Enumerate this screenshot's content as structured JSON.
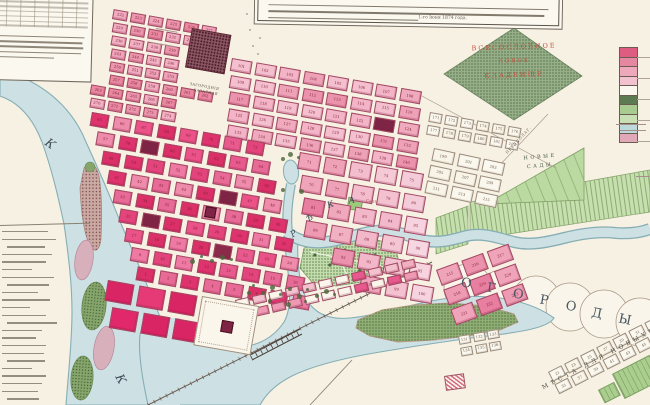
{
  "map_type": "historical-city-plan",
  "colors": {
    "paper": "#f6f1e3",
    "water": "#cde1e4",
    "water_edge": "#86aeb4",
    "block_stroke": "#a04a62",
    "number_ink": "#7d1f35",
    "maroon_block": "#7e2445"
  },
  "annotations": {
    "note_fragment": "1-го Іюня 1874 года.",
    "note_lines_illegible": 3,
    "table_columns": 6,
    "table_rows": 9,
    "table_paragraph_lines": 5,
    "index_list_lines": 23
  },
  "labels": [
    {
      "t": "ВСЕСОСЛОВНОЕ",
      "x": 452,
      "y": 46,
      "r": -2,
      "s": 6.5,
      "ls": 2,
      "c": "#c05040",
      "w": 124,
      "ctr": true
    },
    {
      "t": "НОВОЕ",
      "x": 452,
      "y": 60,
      "r": -2,
      "s": 5.5,
      "ls": 2,
      "c": "#c05040",
      "w": 124,
      "ctr": true
    },
    {
      "t": "КЛАДБИЩЕ",
      "x": 452,
      "y": 74,
      "r": -2,
      "s": 6.5,
      "ls": 2,
      "c": "#c05040",
      "w": 124,
      "ctr": true
    },
    {
      "t": "НОВЫЕ",
      "x": 512,
      "y": 157,
      "r": -5,
      "s": 5,
      "ls": 2.5,
      "c": "#44583e",
      "w": 56,
      "ctr": true
    },
    {
      "t": "САДЫ",
      "x": 512,
      "y": 166,
      "r": -5,
      "s": 5,
      "ls": 2.5,
      "c": "#44583e",
      "w": 56,
      "ctr": true
    },
    {
      "t": "О",
      "x": 462,
      "y": 276,
      "r": 8,
      "s": 13,
      "c": "#4a5660"
    },
    {
      "t": "Г",
      "x": 488,
      "y": 281,
      "r": 8,
      "s": 13,
      "c": "#4a5660"
    },
    {
      "t": "О",
      "x": 514,
      "y": 287,
      "r": 9,
      "s": 13,
      "c": "#4a5660"
    },
    {
      "t": "Р",
      "x": 541,
      "y": 293,
      "r": 10,
      "s": 13,
      "c": "#4a5660"
    },
    {
      "t": "О",
      "x": 567,
      "y": 299,
      "r": 10,
      "s": 13,
      "c": "#4a5660"
    },
    {
      "t": "Д",
      "x": 593,
      "y": 306,
      "r": 11,
      "s": 13,
      "c": "#4a5660"
    },
    {
      "t": "Ы",
      "x": 620,
      "y": 312,
      "r": 12,
      "s": 13,
      "c": "#4a5660"
    },
    {
      "t": "Р",
      "x": 289,
      "y": 232,
      "r": -32,
      "s": 8.5,
      "c": "#3f4c55",
      "i": true
    },
    {
      "t": "Ѣ",
      "x": 305,
      "y": 216,
      "r": -28,
      "s": 8.5,
      "c": "#3f4c55",
      "i": true
    },
    {
      "t": "К",
      "x": 326,
      "y": 202,
      "r": -20,
      "s": 8.5,
      "c": "#3f4c55",
      "i": true
    },
    {
      "t": "А",
      "x": 348,
      "y": 197,
      "r": -8,
      "s": 8.5,
      "c": "#3f4c55",
      "i": true
    },
    {
      "t": "К",
      "x": 50,
      "y": 136,
      "r": 36,
      "s": 12,
      "c": "#3f4c55",
      "i": true
    },
    {
      "t": "К",
      "x": 124,
      "y": 372,
      "r": 62,
      "s": 12,
      "c": "#3f4c55",
      "i": true
    },
    {
      "t": "МѢСТА ДЛЯ НОВЫХЪ САДОВЪ",
      "x": 541,
      "y": 385,
      "r": -27.5,
      "s": 6,
      "ls": 3.5,
      "c": "#4f4e44"
    },
    {
      "t": "ПРЕДПОЛАГ.",
      "x": 505,
      "y": 152,
      "r": -47,
      "s": 3.8,
      "ls": 0.8,
      "c": "#6b5f52"
    },
    {
      "t": "ЗАГОРОДНІЯ",
      "x": 190,
      "y": 82,
      "r": 10,
      "s": 3.6,
      "ls": 0.4,
      "c": "#5c4a42"
    },
    {
      "t": "БАЗАРНАЯ",
      "x": 194,
      "y": 88,
      "r": 10,
      "s": 3.6,
      "ls": 0.4,
      "c": "#5c4a42"
    },
    {
      "t": "Садъ",
      "x": 366,
      "y": 199,
      "r": 4,
      "s": 4,
      "ls": 0.3,
      "c": "#a84444"
    }
  ],
  "palettes": {
    "light": [
      "#f2b4c6",
      "#eea2b8",
      "#f4bfce",
      "#eb93ad",
      "#f0aabe"
    ],
    "light2": [
      "#efa4ba",
      "#ec96ae",
      "#f2b2c4",
      "#ea88a2",
      "#f0acc0"
    ],
    "medium": [
      "#ec92ac",
      "#e87ea0",
      "#f0a4ba",
      "#ee9ab2"
    ],
    "vivid": [
      "#e85a8e",
      "#e4447c",
      "#ee7aa4",
      "#df336e",
      "#ea5288",
      "#e86a96",
      "#db2f68",
      "#ef8cab"
    ],
    "crimson": [
      "#e1286a",
      "#d92564",
      "#e63a76",
      "#dd2f6c"
    ],
    "white": [
      "#faf7ee",
      "#f8f4e8",
      "#fbf8f0"
    ],
    "mixed": [
      "#faf6ec",
      "#ef9ab4",
      "#e4447c",
      "#f4c2cf",
      "#faf6ec",
      "#e85a8e",
      "#f0b0c0",
      "#faf6ec"
    ]
  },
  "districts": [
    {
      "id": "nw",
      "x": 96,
      "y": 6,
      "rot": 10,
      "rows": 8,
      "cols": 7,
      "cw": 15,
      "ch": 10,
      "gx": 3,
      "gy": 3,
      "shift": 1.5,
      "palette": "light2",
      "numStart": 221,
      "seed": 11,
      "skips": [
        "0,0",
        "1,0",
        "2,0",
        "3,0",
        "4,0",
        "5,0",
        "2,5",
        "2,6",
        "3,5",
        "3,6",
        "4,5",
        "4,6",
        "6,5",
        "6,6",
        "7,5",
        "7,6"
      ]
    },
    {
      "id": "ne",
      "x": 232,
      "y": 58,
      "rot": 10,
      "rows": 5,
      "cols": 8,
      "cw": 21,
      "ch": 13,
      "gx": 3.5,
      "gy": 3.5,
      "shift": 2,
      "palette": "light",
      "numStart": 101,
      "seed": 7,
      "overrides": [
        {
          "r": 2,
          "c": 6,
          "color": "#7e2445"
        }
      ]
    },
    {
      "id": "se-white",
      "x": 430,
      "y": 112,
      "rot": 10,
      "rows": 2,
      "cols": 6,
      "cw": 13,
      "ch": 10,
      "gx": 3,
      "gy": 3,
      "palette": "white",
      "numStart": 171,
      "seed": 3
    },
    {
      "id": "e-parcels",
      "x": 434,
      "y": 148,
      "rot": 12,
      "rows": 3,
      "cols": 3,
      "cw": 22,
      "ch": 13,
      "gx": 3.5,
      "gy": 3.5,
      "palette": "white",
      "numStart": 199,
      "numStep": 2,
      "seed": 4
    },
    {
      "id": "core",
      "x": 92,
      "y": 112,
      "rot": 10,
      "rows": 9,
      "cols": 8,
      "cw": 18,
      "ch": 14,
      "gx": 4.5,
      "gy": 4,
      "shift": 9,
      "palette": "vivid",
      "numStart": 1,
      "reverse": true,
      "seed": 5,
      "overrides": [
        {
          "r": 1,
          "c": 2,
          "color": "#7e2445"
        },
        {
          "r": 3,
          "c": 5,
          "color": "#7e2445"
        },
        {
          "r": 5,
          "c": 1,
          "color": "#7e2445"
        },
        {
          "r": 6,
          "c": 4,
          "color": "#8c2a4a"
        }
      ]
    },
    {
      "id": "ec",
      "x": 300,
      "y": 152,
      "rot": 10,
      "rows": 6,
      "cols": 5,
      "cw": 22,
      "ch": 17,
      "gx": 4,
      "gy": 5,
      "shift": 6,
      "palette": "medium",
      "fade": true,
      "numStart": 71,
      "seed": 9,
      "skips": [
        "4,0",
        "5,0",
        "5,1"
      ]
    },
    {
      "id": "s-crimson",
      "x": 108,
      "y": 280,
      "rot": 10,
      "rows": 2,
      "cols": 3,
      "cw": 27,
      "ch": 21,
      "gx": 5,
      "gy": 5,
      "shift": 9,
      "palette": "crimson",
      "numbers": false,
      "seed": 6
    },
    {
      "id": "riverside",
      "x": 235,
      "y": 300,
      "rot": -13,
      "rows": 2,
      "cols": 11,
      "cw": 14,
      "ch": 9,
      "gx": 3,
      "gy": 3,
      "palette": "mixed",
      "numbers": false,
      "seed": 8
    },
    {
      "id": "sb",
      "x": 436,
      "y": 270,
      "rot": -20,
      "rows": 3,
      "cols": 3,
      "cw": 23,
      "ch": 17,
      "gx": 4,
      "gy": 4,
      "palette": "medium",
      "numStart": 215,
      "seed": 10
    },
    {
      "id": "sb-white",
      "x": 458,
      "y": 336,
      "rot": -10,
      "rows": 2,
      "cols": 3,
      "cw": 12,
      "ch": 9,
      "gx": 2.5,
      "gy": 2.5,
      "palette": "white",
      "numStart": 131,
      "seed": 12
    },
    {
      "id": "corner",
      "x": 548,
      "y": 372,
      "rot": -27,
      "rows": 2,
      "cols": 7,
      "cw": 15,
      "ch": 11,
      "gx": 3,
      "gy": 3,
      "palette": "white",
      "numStart": 21,
      "numStep": 2,
      "seed": 13
    }
  ],
  "legend": {
    "swatches": [
      {
        "color": "#dd5c80"
      },
      {
        "color": "#e687a2"
      },
      {
        "color": "#eea8bc"
      },
      {
        "color": "#f2c2d0"
      },
      {
        "color": "#faf7ee"
      },
      {
        "color": "#5d7a52",
        "style": "stipple"
      },
      {
        "color": "#a8cb90"
      },
      {
        "color": "#c8dfb4"
      },
      {
        "color": "#bcd9dc",
        "style": "water"
      },
      {
        "color": "#e0a8b8",
        "style": "hatch"
      }
    ]
  },
  "trees": [
    [
      252,
      284
    ],
    [
      261,
      291
    ],
    [
      270,
      285
    ],
    [
      279,
      293
    ],
    [
      288,
      287
    ],
    [
      297,
      294
    ],
    [
      306,
      288
    ],
    [
      315,
      294
    ],
    [
      324,
      289
    ],
    [
      333,
      293
    ],
    [
      268,
      299
    ],
    [
      286,
      302
    ],
    [
      304,
      300
    ],
    [
      247,
      291
    ],
    [
      190,
      259
    ],
    [
      200,
      255
    ],
    [
      210,
      259
    ],
    [
      220,
      255
    ],
    [
      230,
      258
    ],
    [
      281,
      157
    ],
    [
      288,
      152
    ],
    [
      297,
      156
    ],
    [
      281,
      188
    ],
    [
      299,
      189
    ]
  ],
  "index_line_widths": [
    46,
    54,
    38,
    50,
    44,
    30,
    52,
    42,
    36,
    48,
    28,
    44,
    50,
    40,
    34,
    44,
    42,
    38,
    30,
    44,
    40,
    36,
    32
  ],
  "micro_stripes": [
    {
      "x": 156,
      "y": 28,
      "w": 22,
      "r": 10
    },
    {
      "x": 151,
      "y": 42,
      "w": 26,
      "r": 10
    },
    {
      "x": 616,
      "y": 124,
      "w": 30,
      "r": 0
    },
    {
      "x": 620,
      "y": 130,
      "w": 26,
      "r": 0
    },
    {
      "x": 636,
      "y": 176,
      "w": 14,
      "r": 0
    }
  ]
}
